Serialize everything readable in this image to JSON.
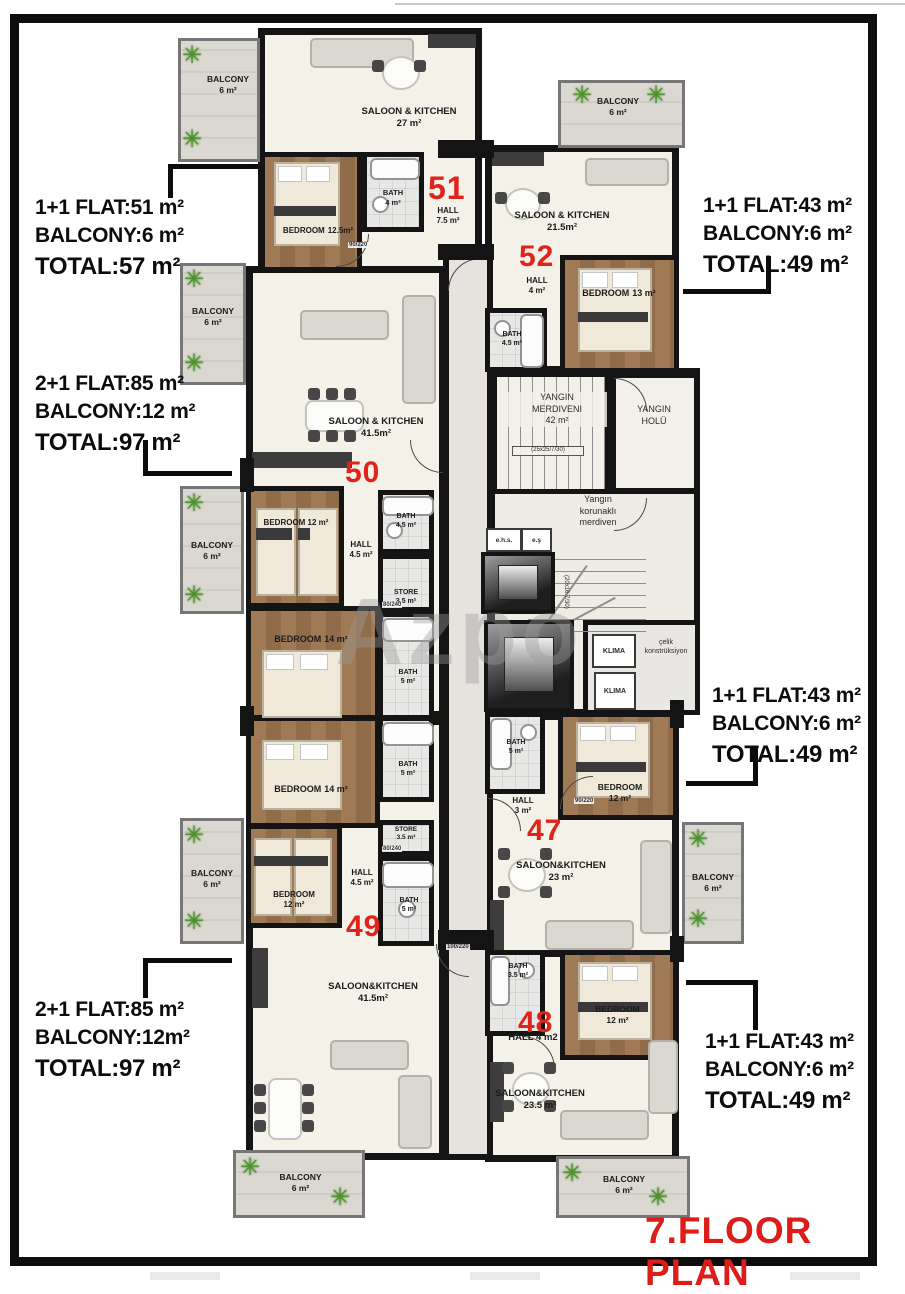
{
  "page": {
    "title": "7.FLOOR PLAN",
    "watermark": "Azpo"
  },
  "colors": {
    "accent_red": "#e0231b",
    "wall_black": "#141414",
    "wood": "#9c7450",
    "marble": "#f4f1ea",
    "balcony_gray": "#d7d4ce"
  },
  "annotations": {
    "left": [
      {
        "line1": "1+1 FLAT:51 m²",
        "line2": "BALCONY:6 m²",
        "line3": "TOTAL:57 m²"
      },
      {
        "line1": "2+1 FLAT:85 m²",
        "line2": "BALCONY:12 m²",
        "line3": "TOTAL:97 m²"
      },
      {
        "line1": "2+1 FLAT:85 m²",
        "line2": "BALCONY:12m²",
        "line3": "TOTAL:97 m²"
      }
    ],
    "right": [
      {
        "line1": "1+1 FLAT:43 m²",
        "line2": "BALCONY:6 m²",
        "line3": "TOTAL:49 m²"
      },
      {
        "line1": "1+1 FLAT:43 m²",
        "line2": "BALCONY:6 m²",
        "line3": "TOTAL:49 m²"
      },
      {
        "line1": "1+1 FLAT:43 m²",
        "line2": "BALCONY:6 m²",
        "line3": "TOTAL:49 m²"
      }
    ]
  },
  "flat_numbers": {
    "f51": "51",
    "f52": "52",
    "f50": "50",
    "f47": "47",
    "f49": "49",
    "f48": "48"
  },
  "rooms": {
    "balc": {
      "name": "BALCONY",
      "area": "6 m²"
    },
    "s51": {
      "name": "SALOON & KITCHEN",
      "area": "27 m²"
    },
    "bed51": {
      "name": "BEDROOM",
      "area": "12.5m²"
    },
    "bath51": {
      "name": "BATH",
      "area": "4 m²"
    },
    "hall51": {
      "name": "HALL",
      "area": "7.5 m²"
    },
    "s52": {
      "name": "SALOON & KITCHEN",
      "area": "21.5m²"
    },
    "hall52": {
      "name": "HALL",
      "area": "4 m²"
    },
    "bed52": {
      "name": "BEDROOM",
      "area": "13 m²"
    },
    "bath52": {
      "name": "BATH",
      "area": "4.5 m²"
    },
    "s50": {
      "name": "SALOON & KITCHEN",
      "area": "41.5m²"
    },
    "bed50": {
      "name": "BEDROOM 12 m²"
    },
    "hall50": {
      "name": "HALL",
      "area": "4.5 m²"
    },
    "bath50": {
      "name": "BATH",
      "area": "4.5 m²"
    },
    "store": {
      "name": "STORE",
      "area": "3.5 m²"
    },
    "bed14": {
      "name": "BEDROOM",
      "area": "14 m²"
    },
    "bath5": {
      "name": "BATH",
      "area": "5 m²"
    },
    "bed49": {
      "name": "BEDROOM",
      "area": "12 m²"
    },
    "hall49": {
      "name": "HALL",
      "area": "4.5 m²"
    },
    "s49": {
      "name": "SALOON&KITCHEN",
      "area": "41.5m²"
    },
    "bath47": {
      "name": "BATH",
      "area": "5 m²"
    },
    "hall47": {
      "name": "HALL",
      "area": "3 m²"
    },
    "bed47": {
      "name": "BEDROOM",
      "area": "12 m²"
    },
    "s47": {
      "name": "SALOON&KITCHEN",
      "area": "23 m²"
    },
    "bath48": {
      "name": "BATH",
      "area": "3.5 m²"
    },
    "hall48": {
      "name": "HALL 4 m2"
    },
    "bed48": {
      "name": "BEDROOM",
      "area": "12 m²"
    },
    "s48": {
      "name": "SALOON&KITCHEN",
      "area": "23.5 m²"
    }
  },
  "core": {
    "fire_stairs": {
      "line1": "YANGIN",
      "line2": "MERDIVENI",
      "line3": "42 m²",
      "spec": "(25x25/7/30)"
    },
    "fire_hall": {
      "line1": "YANGIN",
      "line2": "HOLÜ"
    },
    "protected_stairs": {
      "line1": "Yangın",
      "line2": "korunaklı",
      "line3": "merdiven",
      "spec": "(20x16.7/30)"
    },
    "klima": "KLIMA",
    "celik": {
      "line1": "çelik",
      "line2": "konstrüksiyon"
    },
    "ehs": "e.h.s.",
    "es": "e.ş"
  },
  "dims": {
    "d1": "90/220",
    "d2": "80/240",
    "d3": "100/220",
    "d4": "90/220",
    "d5": "80/240"
  }
}
